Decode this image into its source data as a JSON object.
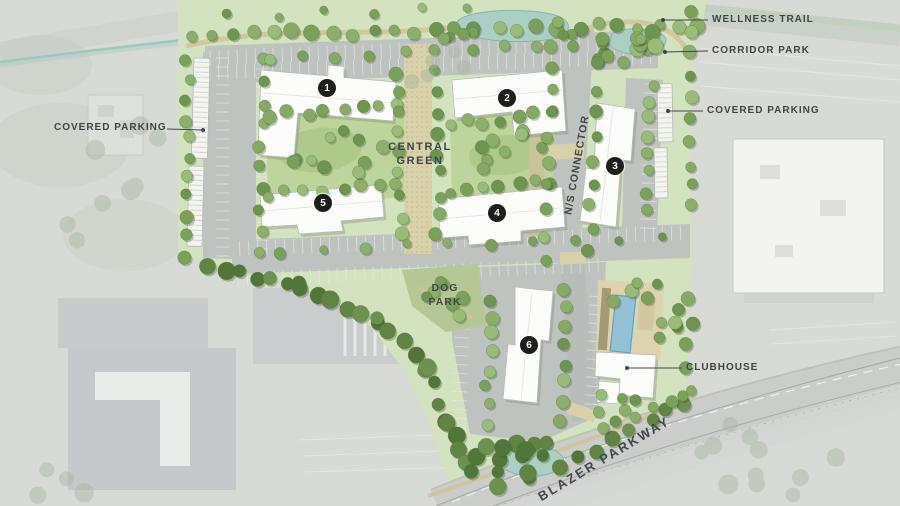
{
  "site_plan": {
    "labels": {
      "wellness_trail": "WELLNESS TRAIL",
      "corridor_park": "CORRIDOR PARK",
      "covered_parking_right": "COVERED PARKING",
      "covered_parking_left": "COVERED PARKING",
      "central_green": "CENTRAL GREEN",
      "ns_connector": "N/S CONNECTOR",
      "dog_park": "DOG PARK",
      "clubhouse": "CLUBHOUSE",
      "blazer_parkway": "BLAZER PARKWAY"
    },
    "buildings": [
      {
        "number": "1"
      },
      {
        "number": "2"
      },
      {
        "number": "3"
      },
      {
        "number": "4"
      },
      {
        "number": "5"
      },
      {
        "number": "6"
      }
    ],
    "colors": {
      "plan_green": "#d3e2bf",
      "courtyard_green": "#bdd49c",
      "dogpark_green": "#b5c794",
      "tree_green": "#7aa159",
      "tree_dark": "#5f8444",
      "road_gray": "#bfc3c0",
      "water_teal": "#abcfc5",
      "pool_blue": "#92c2d7",
      "path_tan": "#d9d1a9",
      "building_white": "#fcfcfa",
      "label_text": "#3f4547",
      "badge_black": "#1e1f1d"
    }
  }
}
